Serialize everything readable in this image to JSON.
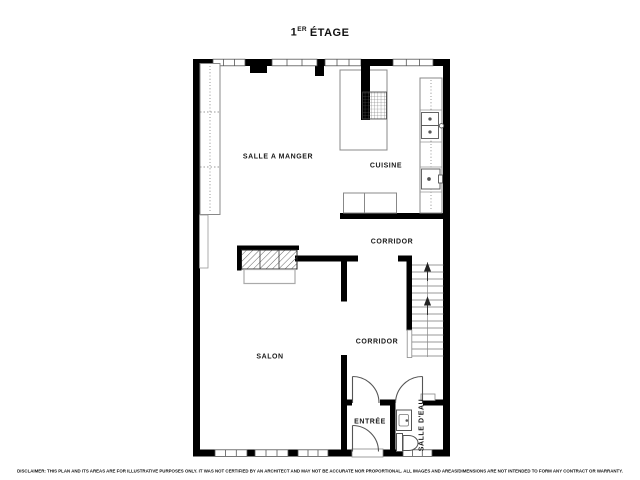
{
  "title": {
    "number": "1",
    "ordinal": "ER",
    "word": "ÉTAGE"
  },
  "rooms": [
    {
      "label": "SALLE A MANGER"
    },
    {
      "label": "CUISINE"
    },
    {
      "label": "CORRIDOR"
    },
    {
      "label": "CORRIDOR"
    },
    {
      "label": "SALON"
    },
    {
      "label": "ENTRÉE"
    },
    {
      "label": "SALLE D'EAU"
    }
  ],
  "disclaimer": "DISCLAIMER: THIS PLAN AND ITS AREAS ARE FOR ILLUSTRATIVE PURPOSES ONLY. IT WAS NOT CERTIFIED BY AN ARCHITECT AND MAY NOT BE ACCURATE NOR PROPORTIONAL. ALL IMAGES AND AREAS/DIMENSIONS ARE NOT INTENDED TO FORM ANY CONTRACT OR WARRANTY.",
  "colors": {
    "wall": "#000000",
    "furniture_outline": "#888888",
    "text": "#1a1a1a",
    "background": "#ffffff"
  }
}
